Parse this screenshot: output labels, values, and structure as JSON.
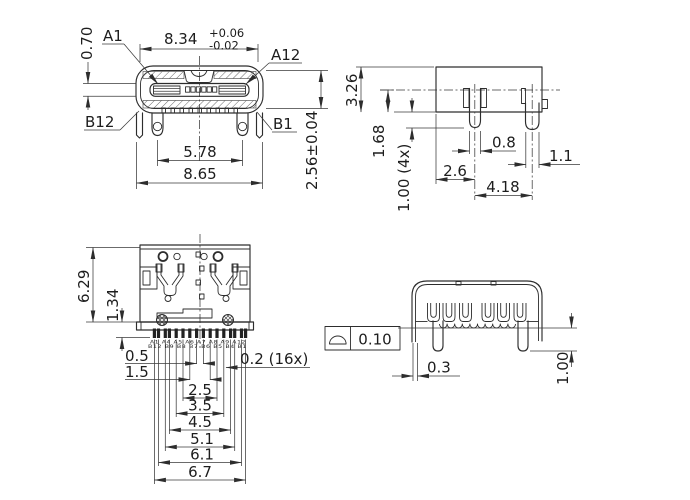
{
  "drawing": {
    "front_view": {
      "shell_width": "8.34",
      "shell_width_tol_upper": "+0.06",
      "shell_width_tol_lower": "-0.02",
      "pin_a1": "A1",
      "pin_a12": "A12",
      "pin_b12": "B12",
      "pin_b1": "B1",
      "peg_span": "5.78",
      "overall_width": "8.65",
      "shell_height": "2.56±0.04",
      "tongue_offset": "0.70"
    },
    "side_view": {
      "shell_height": "3.26",
      "centerline_to_base": "1.68",
      "leg_length": "1.00 (4x)",
      "pin_width": "0.8",
      "holddown_width": "1.1",
      "edge_to_pin": "2.6",
      "pin_to_holddown": "4.18"
    },
    "top_view": {
      "body_depth": "6.29",
      "pin_tail_length": "1.34",
      "pitch_dims": [
        "0.5",
        "1.5",
        "2.5",
        "3.5",
        "4.5",
        "5.1",
        "6.1",
        "6.7"
      ],
      "pin_width": "0.2 (16x)",
      "pin_row_a": "A1 A4 A5 A6 A7 A8 A9 A12",
      "pin_row_b": "B12 B9 B8 B7 B6 B5 B4 B1"
    },
    "rear_view": {
      "profile_tolerance": "0.10",
      "shell_thickness": "0.3",
      "standoff_height": "1.00"
    }
  }
}
